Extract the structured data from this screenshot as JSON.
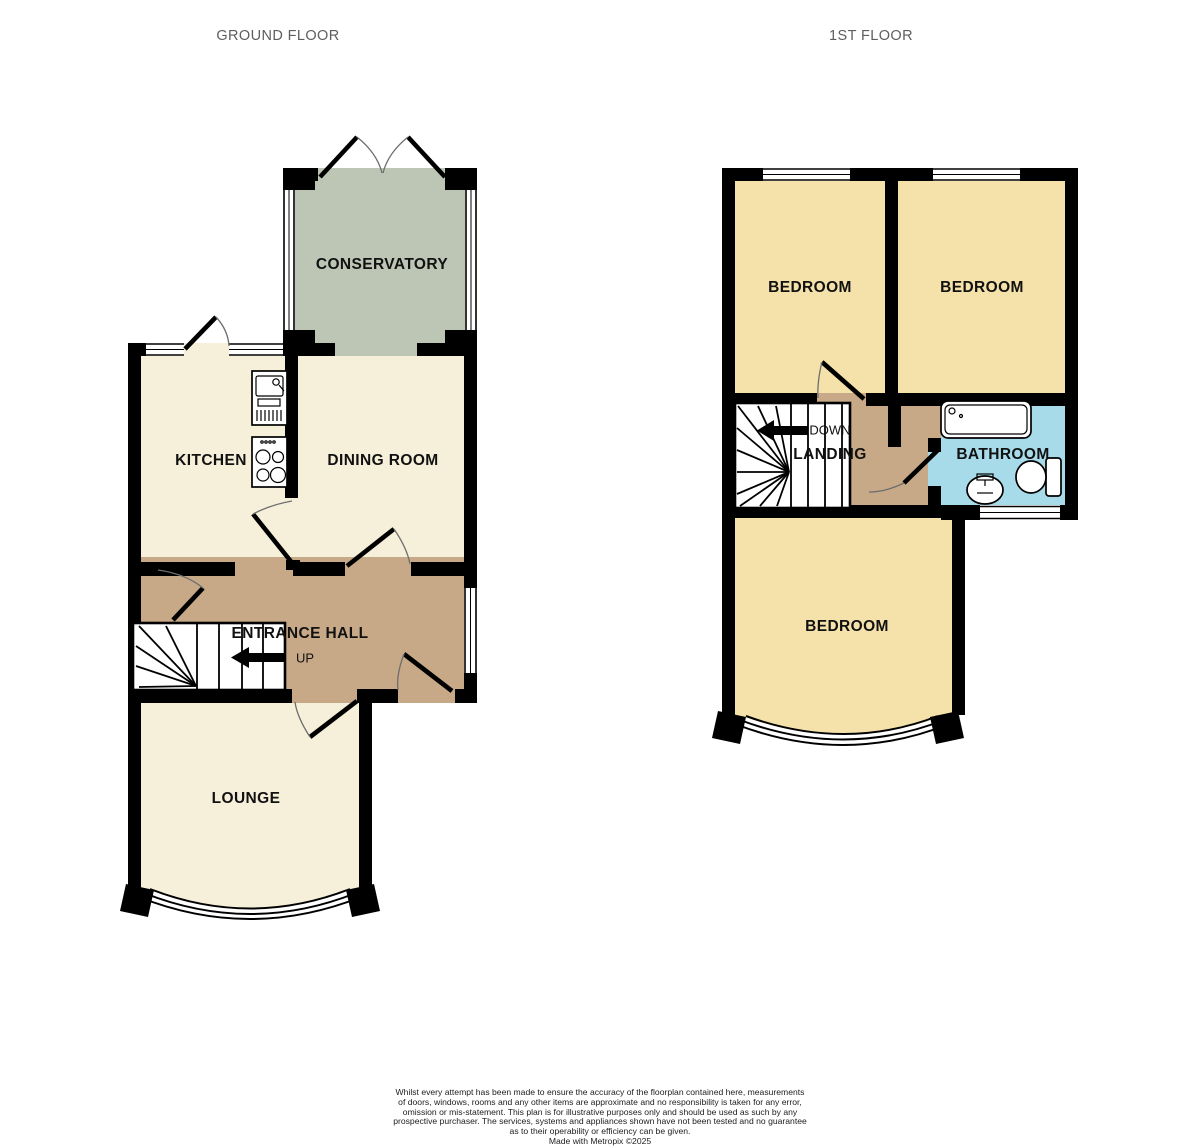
{
  "ground_floor": {
    "title": "GROUND FLOOR",
    "rooms": {
      "conservatory": "CONSERVATORY",
      "kitchen": "KITCHEN",
      "dining_room": "DINING ROOM",
      "entrance_hall": "ENTRANCE HALL",
      "lounge": "LOUNGE"
    },
    "stairs_direction": "UP"
  },
  "first_floor": {
    "title": "1ST FLOOR",
    "rooms": {
      "bedroom_left": "BEDROOM",
      "bedroom_right": "BEDROOM",
      "bedroom_bottom": "BEDROOM",
      "landing": "LANDING",
      "bathroom": "BATHROOM"
    },
    "stairs_direction": "DOWN"
  },
  "footer": {
    "disclaimer": "Whilst every attempt has been made to ensure the accuracy of the floorplan contained here, measurements\nof doors, windows, rooms and any other items are approximate and no responsibility is taken for any error,\nomission or mis-statement. This plan is for illustrative purposes only and should be used as such by any\nprospective purchaser. The services, systems and appliances shown have not been tested and no guarantee\nas to their operability or efficiency can be given.\nMade with Metropix ©2025"
  },
  "colors": {
    "room_cream": "#F6EFDA",
    "conservatory_green": "#BDC5B4",
    "hall_tan": "#C7A987",
    "bedroom_yellow": "#F5E2AB",
    "bathroom_blue": "#A8DBEA",
    "wall_black": "#000000",
    "title_gray": "#5E5E5E"
  }
}
